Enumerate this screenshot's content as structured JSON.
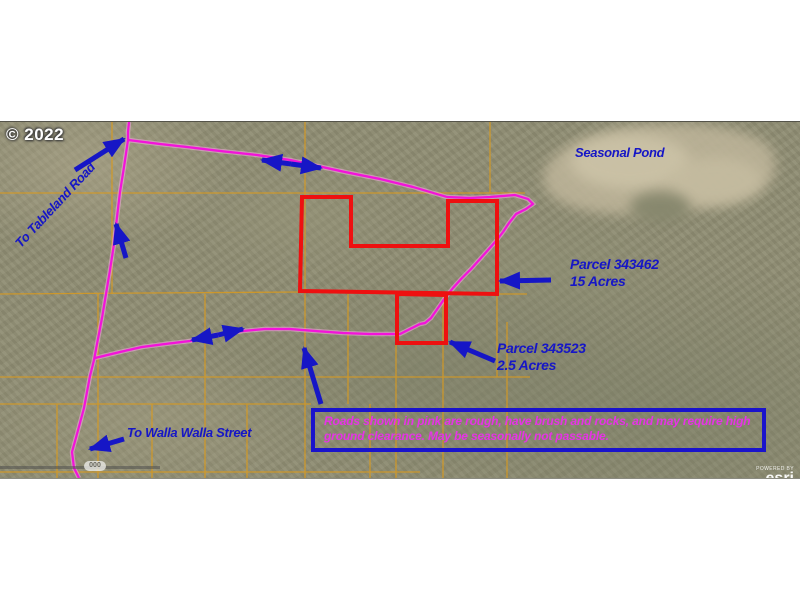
{
  "map": {
    "copyright": "© 2022",
    "labels": {
      "tableland_road": "To Tableland Road",
      "seasonal_pond": "Seasonal Pond",
      "parcel_343462_name": "Parcel 343462",
      "parcel_343462_size": "15 Acres",
      "parcel_343523_name": "Parcel 343523",
      "parcel_343523_size": "2.5 Acres",
      "walla_walla_street": "To Walla Walla Street"
    },
    "notice": {
      "line1": "Roads shown in pink are rough, have brush and rocks, and may require high",
      "line2": "ground clearance. May be seasonally not passable."
    },
    "scale_badge": "000",
    "watermark": {
      "powered_by": "POWERED BY",
      "brand": "esri"
    },
    "colors": {
      "road_pink": "#f312da",
      "parcel_red": "#ee1010",
      "annotation_blue": "#1616c6",
      "grid_orange": "#d89a20",
      "notice_text_magenta": "#e633e6",
      "notice_border_blue": "#1a13cc",
      "terrain_olive": "#8f8d73",
      "pond_tan": "#bcb398"
    }
  }
}
